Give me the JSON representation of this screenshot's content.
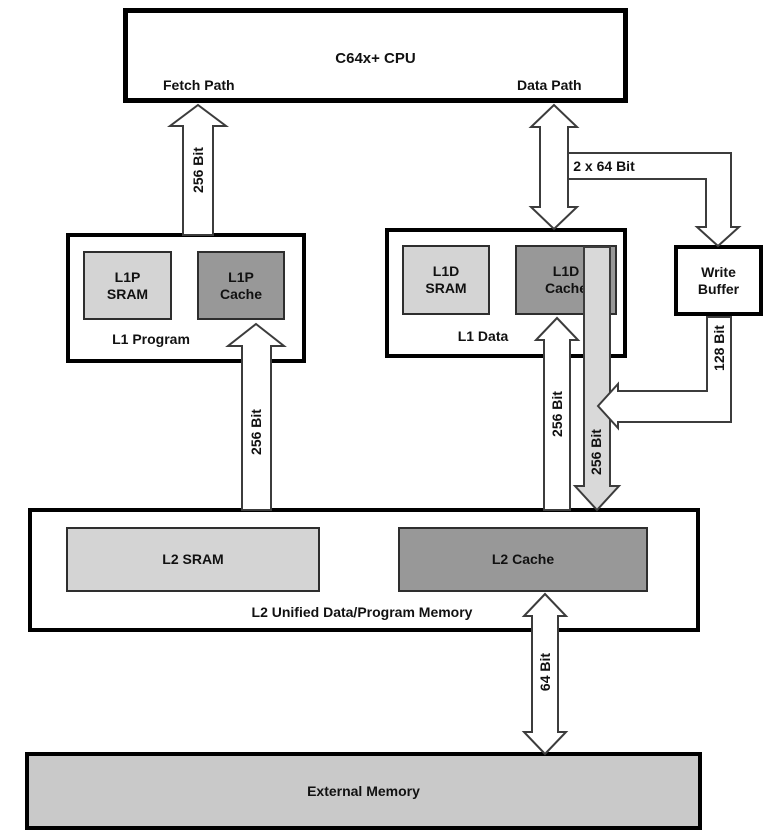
{
  "colors": {
    "sram_fill": "#d4d4d4",
    "cache_fill": "#989898",
    "external_fill": "#c9c9c9",
    "gray_arrow_fill": "#d9d9d9"
  },
  "cpu": {
    "title": "C64x+ CPU",
    "fetch_path": "Fetch Path",
    "data_path": "Data Path"
  },
  "l1_program": {
    "label": "L1 Program",
    "sram": "L1P\nSRAM",
    "cache": "L1P\nCache"
  },
  "l1_data": {
    "label": "L1 Data",
    "sram": "L1D\nSRAM",
    "cache": "L1D\nCache"
  },
  "write_buffer": {
    "label": "Write\nBuffer"
  },
  "l2": {
    "label": "L2 Unified Data/Program Memory",
    "sram": "L2 SRAM",
    "cache": "L2 Cache"
  },
  "external_memory": {
    "label": "External Memory"
  },
  "bus_labels": {
    "fetch": "256 Bit",
    "data": "2 x 64 Bit",
    "l1p_l2": "256 Bit",
    "l1d_read": "256 Bit",
    "l1d_write": "256 Bit",
    "write_buffer_bus": "128 Bit",
    "external_bus": "64 Bit"
  }
}
